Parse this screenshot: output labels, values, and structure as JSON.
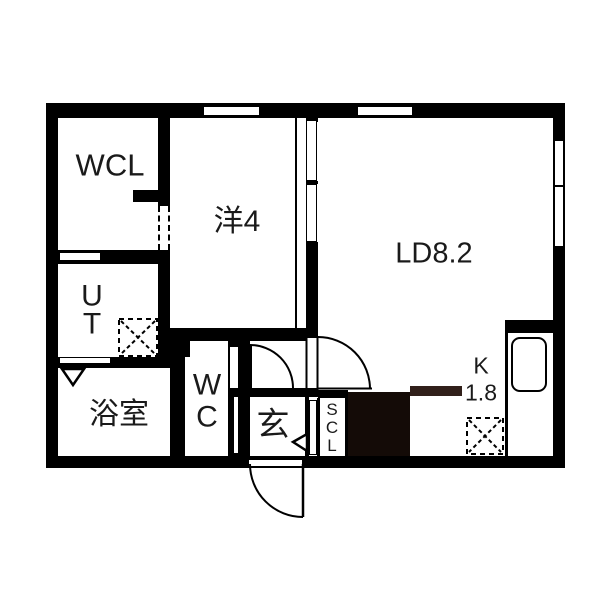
{
  "floorplan": {
    "rooms": {
      "wcl": {
        "label": "WCL"
      },
      "western_room": {
        "label": "洋4"
      },
      "living_dining": {
        "label": "LD8.2"
      },
      "utility": {
        "label": "U\nT"
      },
      "bathroom": {
        "label": "浴室"
      },
      "toilet": {
        "label": "W\nC"
      },
      "entrance": {
        "label": "玄"
      },
      "shoe_closet": {
        "label": "S\nC\nL"
      },
      "kitchen": {
        "label": "K",
        "size": "1.8"
      }
    },
    "symbols": [
      "door-swing-arc",
      "sliding-door-panel",
      "window-inset",
      "opening-inset",
      "washing-machine-space",
      "refrigerator-space",
      "kitchen-sink",
      "door-direction-triangle",
      "kitchen-counter-block"
    ],
    "colors": {
      "wall": "#000000",
      "background": "#ffffff",
      "kitchen_block": "#140b07",
      "kitchen_counter": "#31201a"
    }
  }
}
